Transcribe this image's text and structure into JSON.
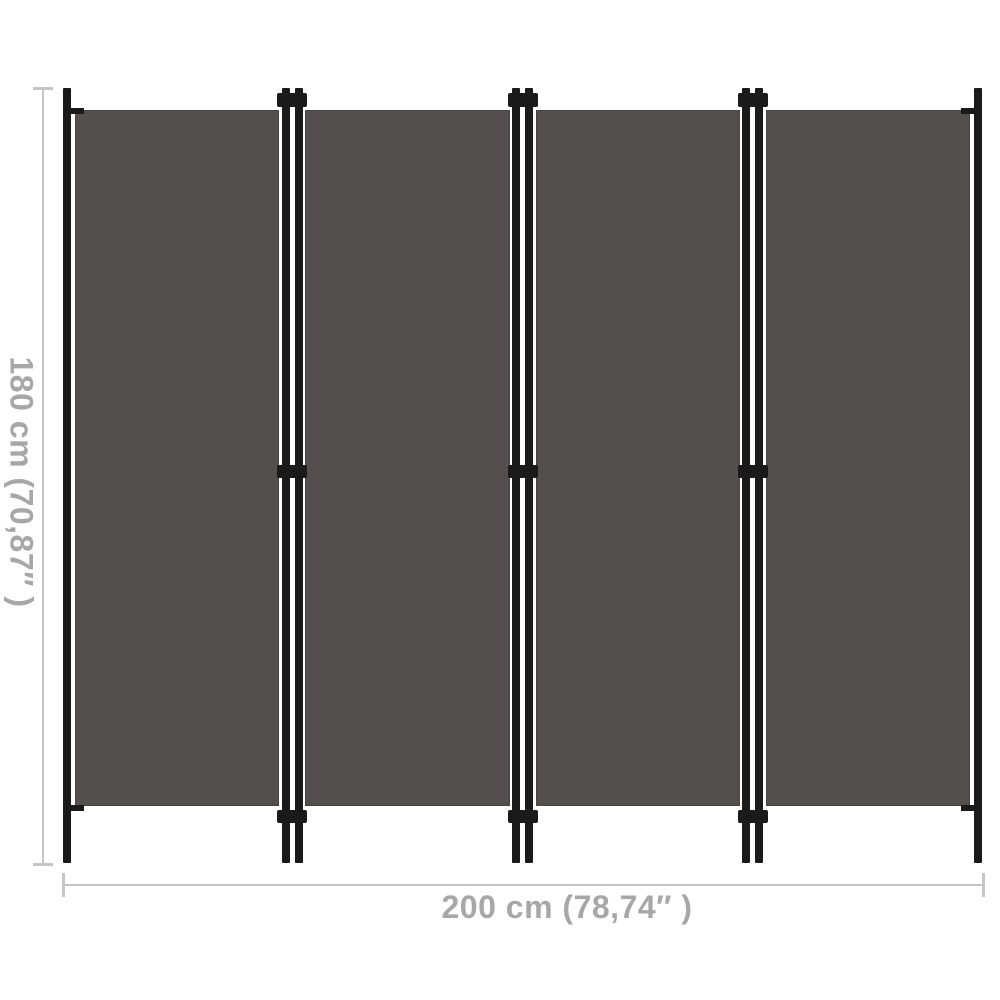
{
  "product": {
    "name": "4-panel room divider screen",
    "panel_count": 4
  },
  "dimensions": {
    "height": {
      "label": "180 cm (70,87″ )"
    },
    "width": {
      "label": "200 cm (78,74″ )"
    }
  },
  "colors": {
    "background": "#ffffff",
    "fabric": "#544e4c",
    "frame": "#1a1a1a",
    "dim-line": "#c6c4c4",
    "dim-text": "#a8a6a6"
  }
}
